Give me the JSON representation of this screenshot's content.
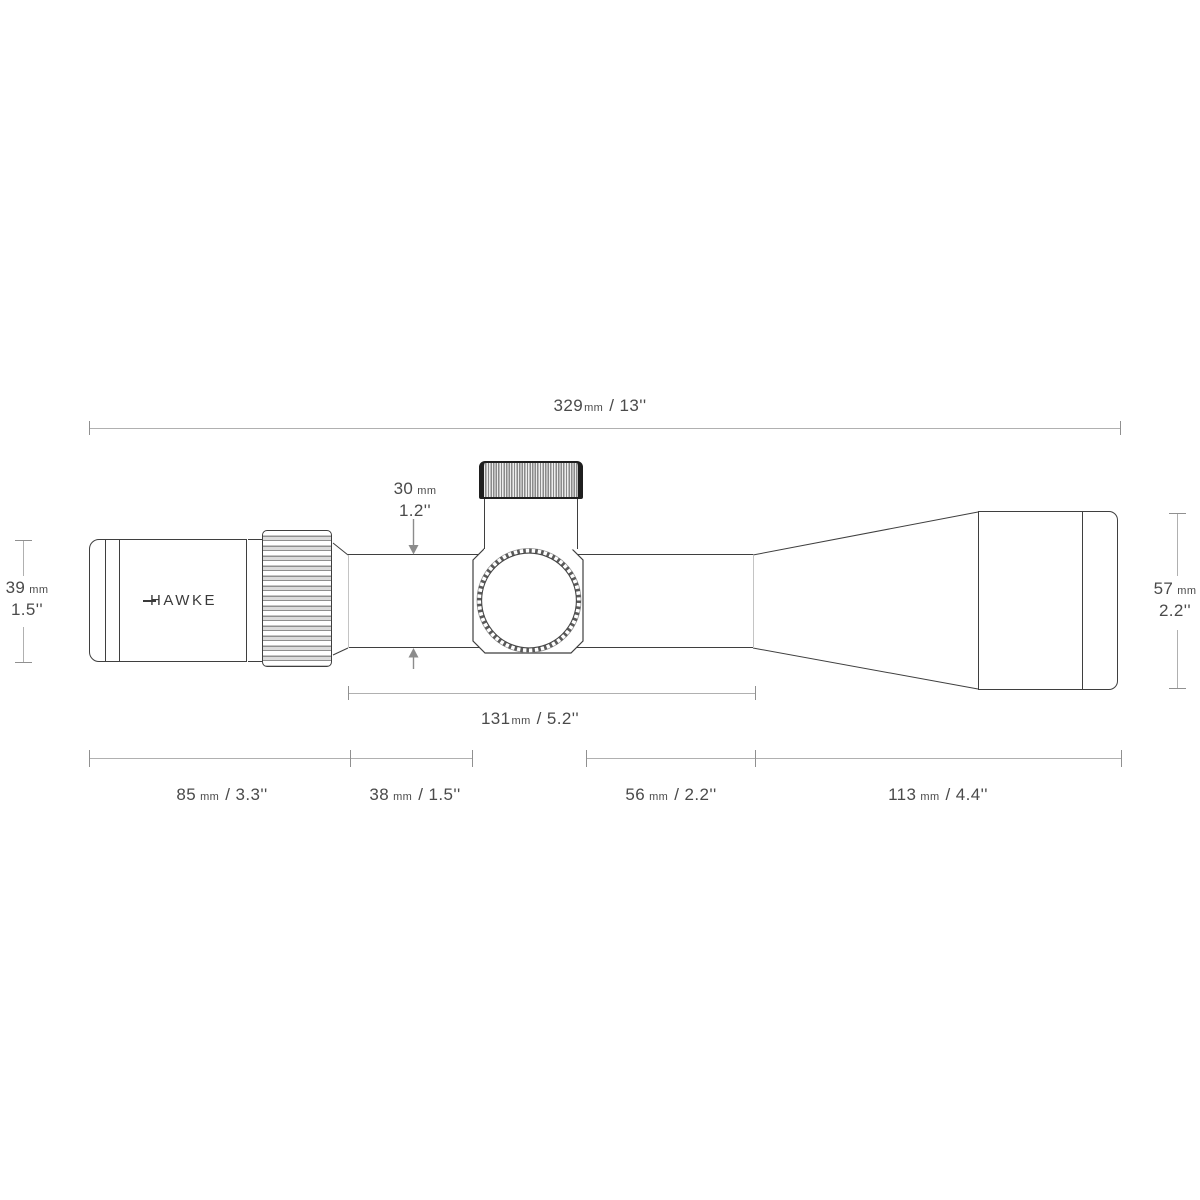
{
  "logo": {
    "text": "HAWKE"
  },
  "colors": {
    "outline": "#3f3f3f",
    "dimension_line": "#b0b0b0",
    "tick": "#909090",
    "label_text": "#4a4a4a",
    "arrow": "#8c8c8c",
    "turret_cap_dark": "#1f1f1f"
  },
  "dims": {
    "total": {
      "value": "329",
      "unit": "mm",
      "imperial": "/ 13''"
    },
    "mid": {
      "value": "131",
      "unit": "mm",
      "imperial": "/ 5.2''"
    },
    "eyepiece_len": {
      "value": "85",
      "unit": "mm",
      "imperial": "/ 3.3''"
    },
    "front_tube": {
      "value": "38",
      "unit": "mm",
      "imperial": "/ 1.5''"
    },
    "rear_tube": {
      "value": "56",
      "unit": "mm",
      "imperial": "/ 2.2''"
    },
    "objective_len": {
      "value": "113",
      "unit": "mm",
      "imperial": "/ 4.4''"
    },
    "ocular_dia": {
      "value": "39",
      "unit": "mm",
      "imperial": "1.5''"
    },
    "tube_dia": {
      "value": "30",
      "unit": "mm",
      "imperial": "1.2''"
    },
    "objective_dia": {
      "value": "57",
      "unit": "mm",
      "imperial": "2.2''"
    }
  }
}
